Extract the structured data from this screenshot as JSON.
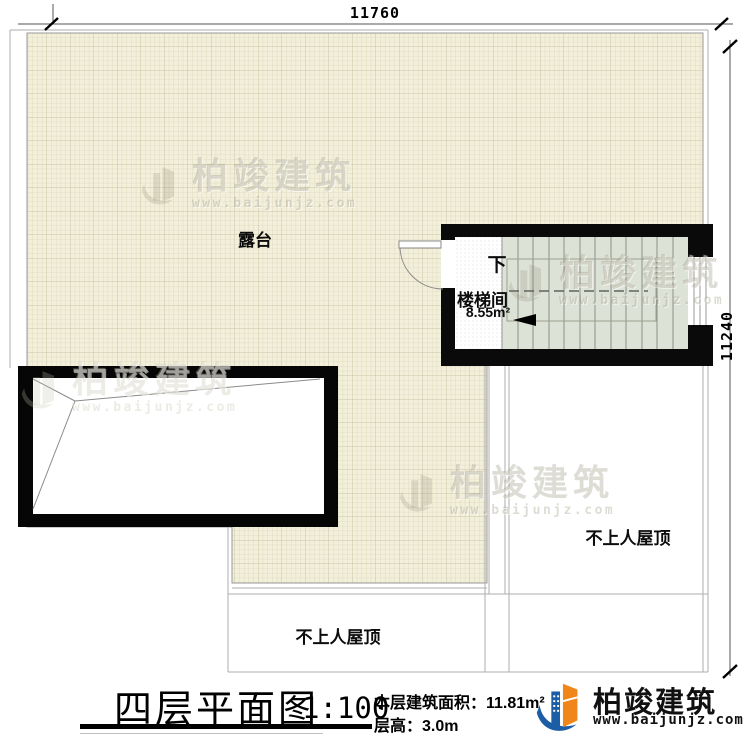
{
  "drawing": {
    "dim_top": "11760",
    "dim_right": "11240",
    "terrace_label": "露台",
    "stairwell_label": "楼梯间",
    "stairwell_area": "8.55m²",
    "stair_direction": "下",
    "roof_label_right": "不上人屋顶",
    "roof_label_bottom": "不上人屋顶"
  },
  "title_block": {
    "title": "四层平面图",
    "scale": "1:100",
    "area_text": "本层建筑面积：11.81m²",
    "height_text": "层高：3.0m"
  },
  "brand": {
    "name": "柏竣建筑",
    "website": "www.baijunjz.com"
  },
  "watermark": {
    "name": "柏竣建筑",
    "website": "www.baijunjz.com"
  },
  "colors": {
    "terrace_fill": "#f2efdb",
    "grid_line": "#ddd8ba",
    "stair_fill": "#dde2d6",
    "wall": "#0a0a0a",
    "brand_blue": "#1b5ea6",
    "brand_orange": "#f08519"
  }
}
